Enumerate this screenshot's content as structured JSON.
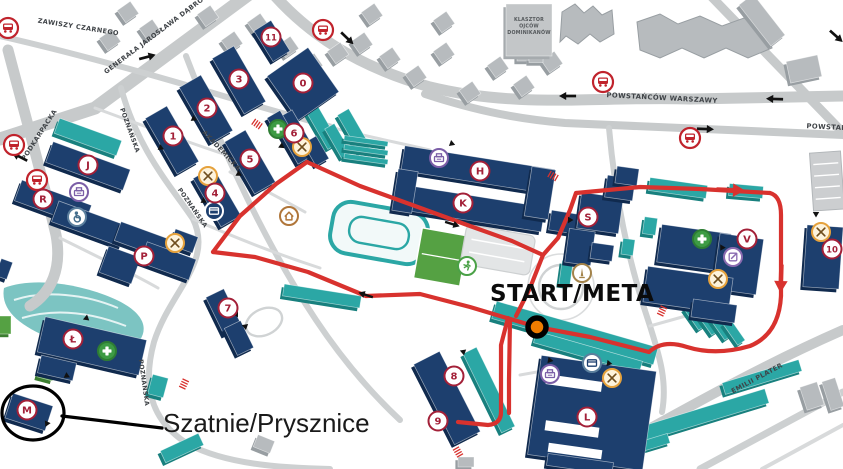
{
  "canvas": {
    "w": 843,
    "h": 469
  },
  "colors": {
    "building_navy": "#1d3f6e",
    "building_navy_side": "#102a4e",
    "building_teal": "#2ba7a5",
    "building_teal_side": "#18807e",
    "building_gray": "#b7bbbe",
    "building_gray_side": "#989ea2",
    "field_green": "#55a143",
    "road_major": "#c7cacb",
    "road_minor": "#d8dadb",
    "route_red": "#d8322e",
    "badge_red": "#a32038",
    "start_orange": "#ef7c00"
  },
  "roads": [
    {
      "d": "M705,-10 L850,140",
      "w": 9,
      "c": "#c7cacb"
    },
    {
      "d": "M252,-8 L95,108 L0,139",
      "w": 13,
      "c": "#c7cacb"
    },
    {
      "d": "M268,-12 C305,32 355,66 430,87 C520,109 600,96 690,99 L843,96",
      "w": 11,
      "c": "#c7cacb"
    },
    {
      "d": "M425,94 C480,112 520,119 565,123 L843,135",
      "w": 8,
      "c": "#c7cacb"
    },
    {
      "d": "M8,50 C25,115 42,175 56,235 C62,268 52,292 30,306",
      "w": 11,
      "c": "#c7cacb"
    },
    {
      "d": "M0,36 C70,52 150,74 230,98 C270,110 300,118 332,127",
      "w": 6,
      "c": "#cdd0d1"
    },
    {
      "d": "M186,56 C222,150 264,242 316,320 C340,356 368,390 400,420",
      "w": 6,
      "c": "#cdd0d1"
    },
    {
      "d": "M121,88 C138,150 170,185 193,219 C214,262 170,291 154,342 C143,382 148,419 188,444 C225,464 280,468 330,469",
      "w": 6,
      "c": "#cdd0d1"
    },
    {
      "d": "M575,469 C650,430 740,375 843,330",
      "w": 10,
      "c": "#c7cacb"
    },
    {
      "d": "M700,469 L843,392",
      "w": 7,
      "c": "#cdd0d1"
    },
    {
      "d": "M609,128 C615,195 627,258 650,326 C658,352 668,380 662,412",
      "w": 6,
      "c": "#cdd0d1"
    },
    {
      "d": "M95,108 C160,132 215,152 258,165",
      "w": 3,
      "c": "#d8dadb"
    },
    {
      "d": "M230,172 C255,185 280,198 305,212",
      "w": 3,
      "c": "#d8dadb"
    },
    {
      "d": "M330,127 C360,135 395,142 430,150",
      "w": 3,
      "c": "#d8dadb"
    },
    {
      "d": "M60,238 C100,258 130,272 158,288",
      "w": 3,
      "c": "#d8dadb"
    },
    {
      "d": "M650,326 L700,312",
      "w": 3,
      "c": "#d8dadb"
    },
    {
      "d": "M640,350 C600,360 560,368 520,375",
      "w": 3,
      "c": "#d8dadb"
    },
    {
      "d": "M762,469 L843,425",
      "w": 4,
      "c": "#d8dadb"
    },
    {
      "d": "M193,219 C240,240 280,255 320,268",
      "w": 3,
      "c": "#d8dadb"
    }
  ],
  "road_labels": [
    {
      "text": "ZAWISZY CZARNEGO",
      "x": 78,
      "y": 29,
      "rot": 9,
      "size": 6.5
    },
    {
      "text": "GENERAŁA JAROSŁAWA DĄBROWSKIEGO",
      "x": 170,
      "y": 26,
      "rot": -37,
      "size": 6.5
    },
    {
      "text": "PODKARPACKA",
      "x": 41,
      "y": 136,
      "rot": -57,
      "size": 6.5
    },
    {
      "text": "POWSTAŃCÓW WARSZAWY",
      "x": 662,
      "y": 100,
      "rot": 3,
      "size": 6.8
    },
    {
      "text": "POWSTAŃCÓW WARSZAWY",
      "x": 862,
      "y": 131,
      "rot": 3,
      "size": 6.8
    },
    {
      "text": "AKADEMICKA",
      "x": 220,
      "y": 152,
      "rot": 47,
      "size": 6.5
    },
    {
      "text": "POZNAŃSKA",
      "x": 128,
      "y": 131,
      "rot": 70,
      "size": 6.2
    },
    {
      "text": "POZNAŃSKA",
      "x": 191,
      "y": 209,
      "rot": 55,
      "size": 6.2
    },
    {
      "text": "POZNAŃSKA",
      "x": 142,
      "y": 383,
      "rot": 82,
      "size": 6.2
    },
    {
      "text": "EMILII PLATER",
      "x": 758,
      "y": 380,
      "rot": -28,
      "size": 6.5
    }
  ],
  "monastery": {
    "lines": [
      "KLASZTOR",
      "OJCÓW",
      "DOMINIKANÓW"
    ],
    "x": 529,
    "y": 21,
    "size": 4.8,
    "rect": [
      529,
      30,
      46,
      52,
      0
    ]
  },
  "pond": {
    "d": "M4,288 C30,278 70,282 105,295 C140,308 150,325 140,340 C120,355 80,350 50,338 C20,326 0,310 4,288 Z"
  },
  "plaza": {
    "cx": 561,
    "cy": 287,
    "r1": 22,
    "r2": 33
  },
  "oval_path_b7": {
    "cx": 264,
    "cy": 322,
    "rx": 19,
    "ry": 13,
    "rot": -25
  },
  "stadium": {
    "cx": 379,
    "cy": 233,
    "rot": 10,
    "ow": 96,
    "oh": 52,
    "iw": 60,
    "ih": 26
  },
  "field": {
    "cx": 441,
    "cy": 257,
    "w": 47,
    "h": 51,
    "rot": 10
  },
  "parking_lot_small": {
    "cx": 498,
    "cy": 250,
    "w": 70,
    "h": 40,
    "rot": 10
  },
  "parking_ne": {
    "cx": 827,
    "cy": 181,
    "w": 31,
    "h": 58,
    "rot": -4,
    "rows": 4
  },
  "buildings": {
    "navy": [
      [
        303,
        84,
        50,
        54,
        -35
      ],
      [
        272,
        41,
        20,
        36,
        -32
      ],
      [
        239,
        80,
        25,
        64,
        -30
      ],
      [
        206,
        109,
        25,
        64,
        -30
      ],
      [
        172,
        140,
        25,
        64,
        -30
      ],
      [
        250,
        162,
        24,
        60,
        -30
      ],
      [
        217,
        197,
        23,
        56,
        -30
      ],
      [
        295,
        137,
        22,
        50,
        -30
      ],
      [
        278,
        122,
        15,
        18,
        -30
      ],
      [
        316,
        151,
        15,
        26,
        -30
      ],
      [
        88,
        166,
        82,
        22,
        20
      ],
      [
        53,
        203,
        74,
        22,
        20
      ],
      [
        90,
        224,
        74,
        22,
        20
      ],
      [
        145,
        241,
        58,
        20,
        20
      ],
      [
        120,
        265,
        34,
        28,
        20
      ],
      [
        168,
        261,
        52,
        22,
        20
      ],
      [
        184,
        241,
        24,
        17,
        20
      ],
      [
        92,
        346,
        104,
        36,
        13
      ],
      [
        57,
        368,
        36,
        18,
        13
      ],
      [
        29,
        412,
        42,
        26,
        18
      ],
      [
        224,
        312,
        20,
        42,
        -26
      ],
      [
        239,
        338,
        18,
        30,
        -26
      ],
      [
        478,
        170,
        152,
        25,
        9
      ],
      [
        470,
        208,
        148,
        25,
        9
      ],
      [
        405,
        191,
        20,
        42,
        9
      ],
      [
        540,
        193,
        24,
        50,
        9
      ],
      [
        563,
        222,
        26,
        20,
        9
      ],
      [
        600,
        213,
        42,
        36,
        8
      ],
      [
        620,
        188,
        28,
        22,
        8
      ],
      [
        580,
        247,
        26,
        34,
        8
      ],
      [
        602,
        252,
        22,
        16,
        8
      ],
      [
        627,
        176,
        22,
        17,
        8
      ],
      [
        694,
        248,
        70,
        38,
        8
      ],
      [
        738,
        264,
        44,
        56,
        8
      ],
      [
        688,
        290,
        86,
        36,
        8
      ],
      [
        714,
        311,
        44,
        18,
        8
      ],
      [
        823,
        257,
        36,
        62,
        4
      ],
      [
        447,
        398,
        29,
        90,
        -27
      ],
      [
        592,
        413,
        116,
        100,
        8
      ],
      [
        580,
        464,
        66,
        12,
        8
      ],
      [
        4,
        269,
        12,
        18,
        20
      ]
    ],
    "navy_notches_white": [
      [
        574,
        383,
        56,
        10,
        8
      ],
      [
        572,
        429,
        54,
        10,
        8
      ],
      [
        575,
        451,
        54,
        9,
        8
      ]
    ],
    "teal": [
      [
        323,
        128,
        13,
        42,
        -30
      ],
      [
        338,
        141,
        11,
        34,
        -30
      ],
      [
        354,
        131,
        13,
        44,
        -30
      ],
      [
        366,
        141,
        44,
        5,
        8
      ],
      [
        366,
        150,
        44,
        5,
        8
      ],
      [
        366,
        159,
        44,
        5,
        8
      ],
      [
        88,
        137,
        66,
        16,
        20
      ],
      [
        678,
        188,
        58,
        13,
        8
      ],
      [
        746,
        191,
        34,
        12,
        5
      ],
      [
        575,
        333,
        168,
        18,
        16
      ],
      [
        588,
        352,
        110,
        12,
        16
      ],
      [
        322,
        296,
        78,
        12,
        9
      ],
      [
        489,
        390,
        15,
        88,
        -26
      ],
      [
        695,
        317,
        9,
        26,
        -35
      ],
      [
        708,
        322,
        9,
        26,
        -35
      ],
      [
        721,
        327,
        9,
        26,
        -35
      ],
      [
        734,
        332,
        9,
        26,
        -35
      ],
      [
        688,
        420,
        165,
        15,
        -17
      ],
      [
        762,
        377,
        80,
        12,
        -17
      ],
      [
        640,
        447,
        60,
        10,
        -17
      ],
      [
        650,
        226,
        13,
        17,
        8
      ],
      [
        566,
        273,
        11,
        24,
        8
      ],
      [
        628,
        247,
        12,
        16,
        8
      ],
      [
        585,
        396,
        58,
        9,
        8
      ],
      [
        158,
        386,
        16,
        20,
        15
      ],
      [
        182,
        448,
        42,
        13,
        -25
      ]
    ],
    "green_misc": [
      [
        5,
        325,
        12,
        18,
        0
      ],
      [
        46,
        374,
        16,
        10,
        15
      ]
    ],
    "gray_misc": [
      [
        804,
        69,
        32,
        22,
        -12
      ],
      [
        762,
        20,
        18,
        52,
        -38
      ],
      [
        812,
        396,
        18,
        24,
        -18
      ],
      [
        833,
        394,
        14,
        30,
        -18
      ],
      [
        264,
        444,
        18,
        13,
        22
      ],
      [
        466,
        462,
        16,
        10,
        0
      ],
      [
        523,
        58,
        12,
        6,
        0
      ],
      [
        536,
        60,
        14,
        5,
        0
      ]
    ],
    "gray_jagged": [
      "M562,12 L575,4 L584,13 L593,6 L602,15 L612,10 L614,34 L600,42 L590,34 L578,44 L566,36 L560,42 Z",
      "M637,22 L660,14 L678,24 L700,16 L722,26 L744,18 L766,28 L772,48 L748,58 L726,48 L704,58 L682,48 L660,58 L640,50 Z"
    ]
  },
  "houses": [
    [
      128,
      12
    ],
    [
      150,
      30
    ],
    [
      110,
      40
    ],
    [
      208,
      16
    ],
    [
      232,
      42
    ],
    [
      258,
      24
    ],
    [
      288,
      47
    ],
    [
      312,
      64
    ],
    [
      338,
      53
    ],
    [
      362,
      43
    ],
    [
      390,
      58
    ],
    [
      416,
      76
    ],
    [
      444,
      53
    ],
    [
      470,
      92
    ],
    [
      498,
      67
    ],
    [
      524,
      86
    ],
    [
      552,
      62
    ],
    [
      372,
      14
    ],
    [
      444,
      22
    ]
  ],
  "badges": [
    {
      "label": "0",
      "x": 303,
      "y": 83
    },
    {
      "label": "11",
      "x": 271,
      "y": 37
    },
    {
      "label": "3",
      "x": 239,
      "y": 79
    },
    {
      "label": "2",
      "x": 207,
      "y": 108
    },
    {
      "label": "1",
      "x": 173,
      "y": 136
    },
    {
      "label": "5",
      "x": 250,
      "y": 159
    },
    {
      "label": "4",
      "x": 215,
      "y": 193
    },
    {
      "label": "6",
      "x": 294,
      "y": 133
    },
    {
      "label": "7",
      "x": 228,
      "y": 308
    },
    {
      "label": "8",
      "x": 454,
      "y": 376
    },
    {
      "label": "9",
      "x": 438,
      "y": 421
    },
    {
      "label": "10",
      "x": 832,
      "y": 249
    },
    {
      "label": "H",
      "x": 480,
      "y": 171
    },
    {
      "label": "K",
      "x": 463,
      "y": 203
    },
    {
      "label": "S",
      "x": 588,
      "y": 217
    },
    {
      "label": "V",
      "x": 747,
      "y": 239
    },
    {
      "label": "J",
      "x": 88,
      "y": 165
    },
    {
      "label": "R",
      "x": 43,
      "y": 199
    },
    {
      "label": "P",
      "x": 144,
      "y": 256
    },
    {
      "label": "Ł",
      "x": 73,
      "y": 339
    },
    {
      "label": "M",
      "x": 27,
      "y": 410
    },
    {
      "label": "L",
      "x": 587,
      "y": 417
    }
  ],
  "icons": [
    {
      "type": "bus",
      "x": 8,
      "y": 28
    },
    {
      "type": "bus",
      "x": 14,
      "y": 145
    },
    {
      "type": "bus",
      "x": 37,
      "y": 180
    },
    {
      "type": "bus",
      "x": 323,
      "y": 30
    },
    {
      "type": "bus",
      "x": 603,
      "y": 82
    },
    {
      "type": "bus",
      "x": 690,
      "y": 138
    },
    {
      "type": "restaurant",
      "x": 208,
      "y": 176
    },
    {
      "type": "restaurant",
      "x": 302,
      "y": 147
    },
    {
      "type": "restaurant",
      "x": 175,
      "y": 243
    },
    {
      "type": "restaurant",
      "x": 718,
      "y": 279
    },
    {
      "type": "restaurant",
      "x": 821,
      "y": 232
    },
    {
      "type": "restaurant",
      "x": 612,
      "y": 378
    },
    {
      "type": "printer",
      "x": 79,
      "y": 192
    },
    {
      "type": "printer",
      "x": 439,
      "y": 158
    },
    {
      "type": "printer",
      "x": 550,
      "y": 374
    },
    {
      "type": "accessibility",
      "x": 77,
      "y": 217
    },
    {
      "type": "atm-dark",
      "x": 214,
      "y": 211
    },
    {
      "type": "atm-light",
      "x": 592,
      "y": 363
    },
    {
      "type": "medical",
      "x": 278,
      "y": 129
    },
    {
      "type": "medical",
      "x": 702,
      "y": 239
    },
    {
      "type": "medical",
      "x": 107,
      "y": 351
    },
    {
      "type": "monument",
      "x": 582,
      "y": 273
    },
    {
      "type": "hostel",
      "x": 289,
      "y": 216
    },
    {
      "type": "sport",
      "x": 467,
      "y": 266
    },
    {
      "type": "registration",
      "x": 733,
      "y": 257
    }
  ],
  "route": {
    "color": "#d8322e",
    "width": 4.2,
    "segments": [
      "M213,252 L240,216 L276,184 L307,162",
      "M307,162 L360,186 L415,206 L470,226 L512,241 L543,255",
      "M543,255 L530,288 L516,316",
      "M543,255 L558,238 L570,210 L576,193",
      "M576,193 L640,187 L700,189 L770,193",
      "M770,193 Q781,196 781,215 L781,296",
      "M781,296 Q779,334 750,346 Q716,356 687,347 Q663,339 649,352",
      "M649,352 L590,337 L537,327 L470,307 L420,294 L366,296 L308,272 L255,257 L213,252",
      "M508,318 L501,345 L501,412 Q501,424 488,425 L458,422",
      "M510,319 L509,380 L509,413"
    ]
  },
  "route_arrows_red": [
    {
      "x": 730,
      "y": 190,
      "rot": 2
    },
    {
      "x": 781,
      "y": 278,
      "rot": 92
    }
  ],
  "route_arrows_black": [
    {
      "x": 452,
      "y": 224,
      "rot": 17
    },
    {
      "x": 366,
      "y": 295,
      "rot": 198
    }
  ],
  "road_arrows": [
    {
      "x": 147,
      "y": 57,
      "rot": -15
    },
    {
      "x": 347,
      "y": 38,
      "rot": 44
    },
    {
      "x": 568,
      "y": 96,
      "rot": 180
    },
    {
      "x": 775,
      "y": 99,
      "rot": 182
    },
    {
      "x": 705,
      "y": 129,
      "rot": 2
    },
    {
      "x": 20,
      "y": 157,
      "rot": 207
    },
    {
      "x": 836,
      "y": 36,
      "rot": 42
    }
  ],
  "entrance_triangles": [
    {
      "x": 192,
      "y": 118,
      "rot": 25
    },
    {
      "x": 159,
      "y": 147,
      "rot": 25
    },
    {
      "x": 237,
      "y": 173,
      "rot": 30
    },
    {
      "x": 202,
      "y": 200,
      "rot": 28
    },
    {
      "x": 280,
      "y": 145,
      "rot": 35
    },
    {
      "x": 450,
      "y": 143,
      "rot": 20
    },
    {
      "x": 568,
      "y": 220,
      "rot": 0
    },
    {
      "x": 723,
      "y": 246,
      "rot": 120
    },
    {
      "x": 85,
      "y": 317,
      "rot": 40
    },
    {
      "x": 65,
      "y": 375,
      "rot": 25
    },
    {
      "x": 48,
      "y": 425,
      "rot": 235
    },
    {
      "x": 548,
      "y": 360,
      "rot": 10
    },
    {
      "x": 607,
      "y": 363,
      "rot": 10
    },
    {
      "x": 463,
      "y": 350,
      "rot": 80
    },
    {
      "x": 238,
      "y": 314,
      "rot": 180
    },
    {
      "x": 247,
      "y": 327,
      "rot": 200
    },
    {
      "x": 816,
      "y": 212,
      "rot": 90
    }
  ],
  "crossing_ticks": [
    {
      "x": 257,
      "y": 124,
      "rot": 35
    },
    {
      "x": 553,
      "y": 176,
      "rot": 30
    },
    {
      "x": 662,
      "y": 311,
      "rot": 115
    },
    {
      "x": 607,
      "y": 381,
      "rot": 35
    },
    {
      "x": 458,
      "y": 452,
      "rot": 60
    },
    {
      "x": 184,
      "y": 384,
      "rot": 115
    }
  ],
  "start": {
    "label": "START/META",
    "marker": {
      "x": 537,
      "y": 327,
      "fill": "#ef7c00"
    }
  },
  "changing_rooms": {
    "label": "Szatnie/Prysznice",
    "ellipse": {
      "cx": 33,
      "cy": 413,
      "rx": 31,
      "ry": 27
    },
    "line": {
      "x1": 62,
      "y1": 416,
      "x2": 162,
      "y2": 428
    }
  }
}
